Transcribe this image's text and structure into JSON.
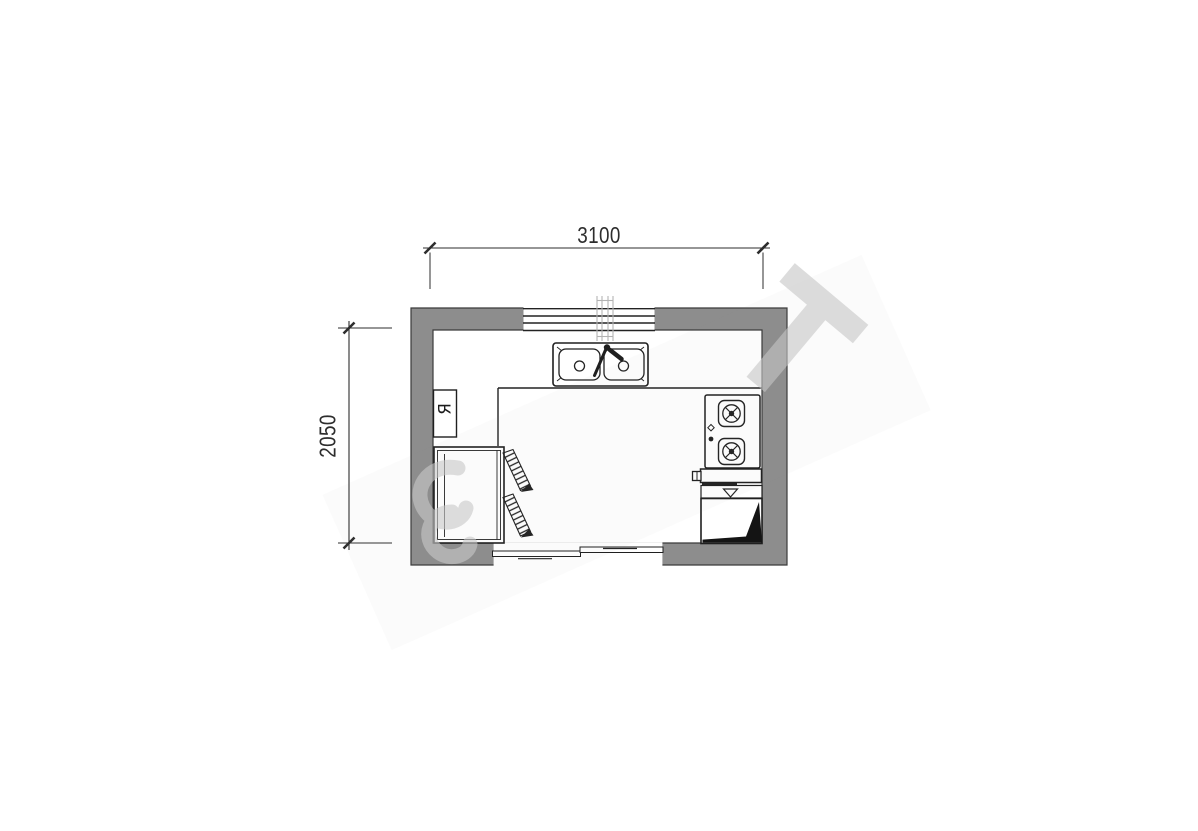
{
  "dimensions": {
    "width_label": "3100",
    "height_label": "2050"
  },
  "labels": {
    "appliance_marker": "Я"
  },
  "colors": {
    "wall_fill": "#8d8d8d",
    "outline": "#222222",
    "dimension_text": "#2d2d2d",
    "watermark": "#c6c6c6",
    "cabinet_shadow": "#141414",
    "background": "#ffffff"
  }
}
